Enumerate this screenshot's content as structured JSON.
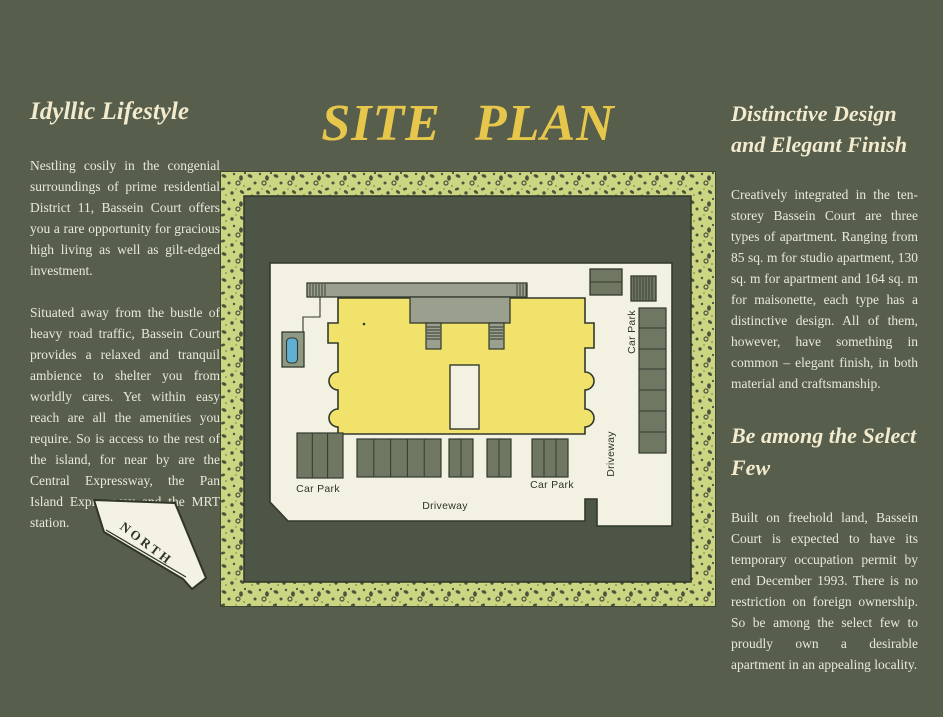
{
  "page": {
    "title": "SITE PLAN",
    "background_color": "#575e4c",
    "title_color": "#e7c74b",
    "heading_color": "#f2ebce",
    "body_text_color": "#e9e9db"
  },
  "left_column": {
    "heading": "Idyllic Lifestyle",
    "paragraph1": "Nestling cosily in the congenial surroundings of prime residential District 11, Bassein Court offers you a rare opportunity for gracious high living as well as gilt-edged investment.",
    "paragraph2": "Situated away from the bustle of heavy road traffic, Bassein Court provides a relaxed and tranquil ambience to shelter you from worldly cares. Yet within easy reach are all the amenities you require. So is access to the rest of the island, for near by are the Central Expressway, the Pan Island Expressway and the MRT station."
  },
  "right_column": {
    "heading1": "Distinctive Design and Elegant Finish",
    "paragraph1": "Creatively integrated in the ten-storey Bassein Court are three types of apartment. Ranging from 85 sq. m for studio apartment, 130 sq. m for apartment and 164 sq. m for maisonette, each type has a distinctive design. All of them, however, have something in common – elegant finish, in both material and craftsmanship.",
    "heading2": "Be among the Select Few",
    "paragraph2": "Built on freehold land, Bassein Court is expected to have its temporary occupation permit by end December 1993. There is no restriction on foreign ownership. So be among the select few to proudly own a desirable apartment in an appealing locality."
  },
  "north_arrow": {
    "label": "NORTH"
  },
  "site_plan": {
    "labels": {
      "car_park_left": "Car Park",
      "car_park_right": "Car Park",
      "car_park_top_right": "Car Park",
      "driveway_bottom": "Driveway",
      "driveway_right": "Driveway"
    },
    "colors": {
      "border_speckle_bg": "#ccd581",
      "border_speckle_dot": "#4c5440",
      "ground_dark_green": "#4d5547",
      "site_white": "#f3f1e2",
      "building_yellow": "#f1e26b",
      "walkway_gray": "#9ba08e",
      "parking_stall_green": "#6f7763",
      "pool_blue": "#5fb0d4",
      "pool_deck": "#8e9883",
      "outline": "#32392c"
    }
  }
}
